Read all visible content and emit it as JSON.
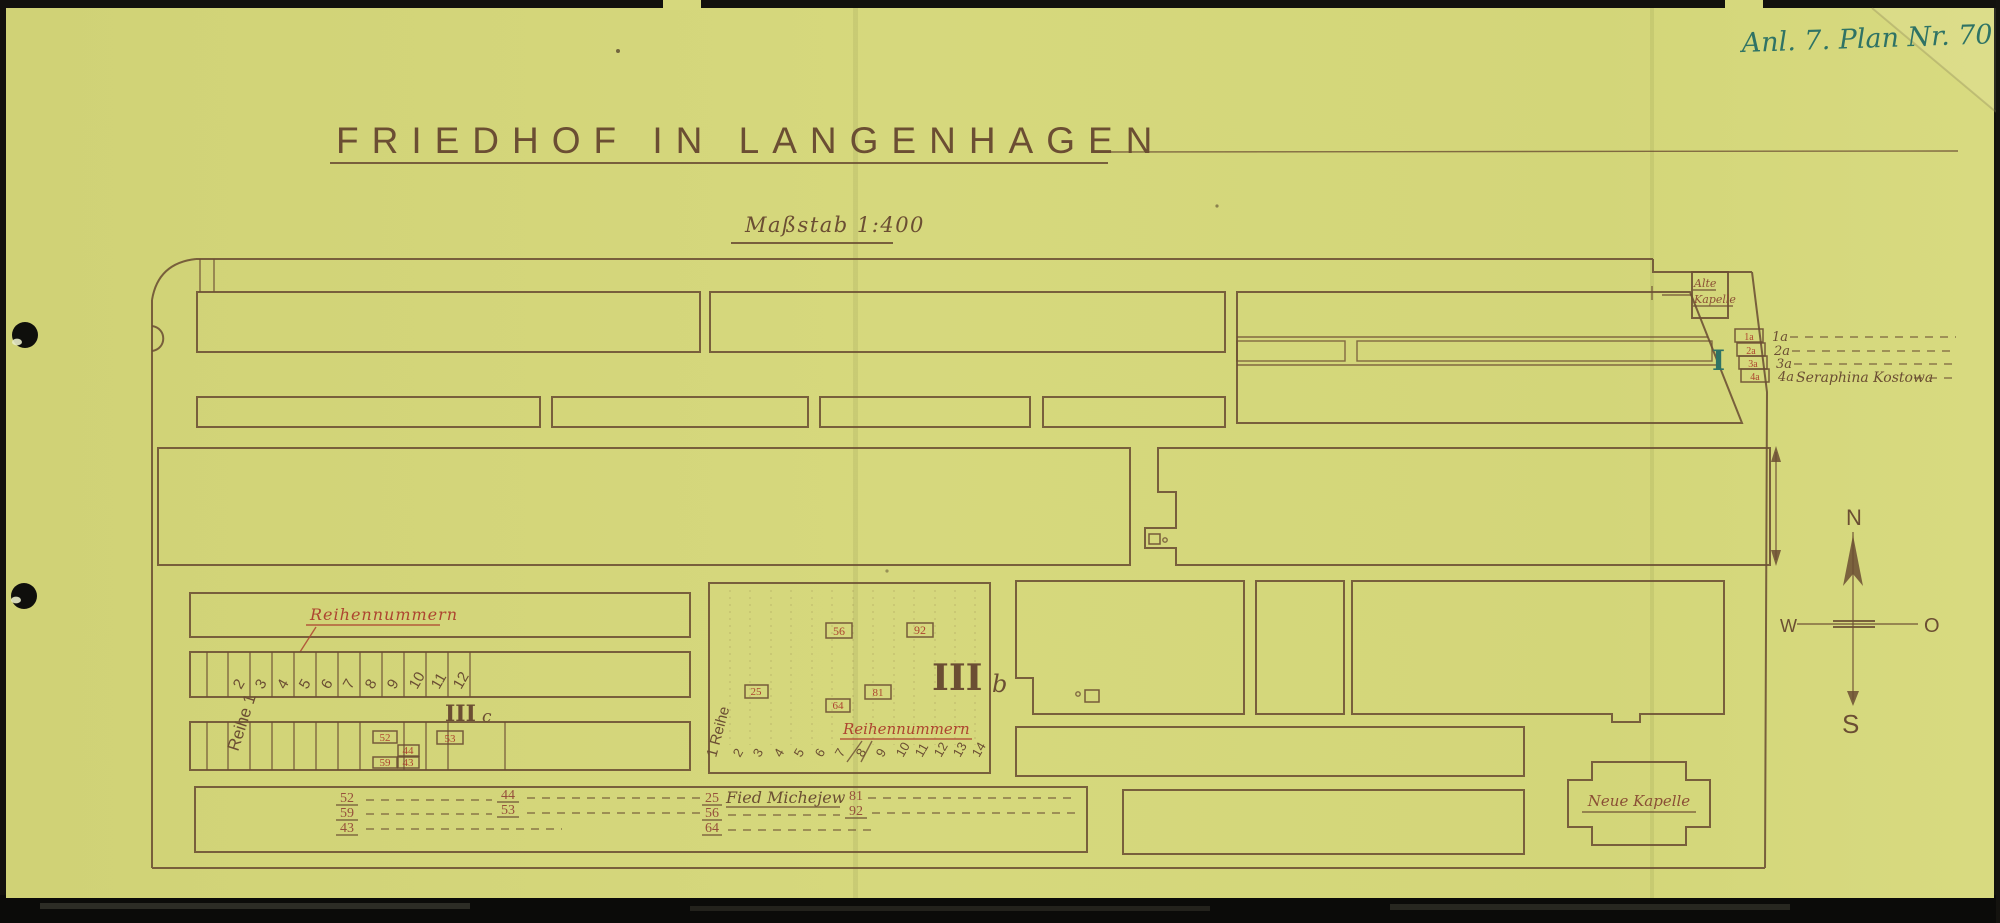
{
  "archive_note": "Anl. 7. Plan Nr. 70",
  "title": "FRIEDHOF IN LANGENHAGEN",
  "scale_label": "Maßstab 1:400",
  "compass": {
    "north": "N",
    "west": "W",
    "east": "O",
    "south": "S"
  },
  "alte_kapelle": {
    "line1": "Alte",
    "line2": "Kapelle"
  },
  "neue_kapelle": {
    "label": "Neue Kapelle"
  },
  "section_I": {
    "mark": "I",
    "grave_boxes": [
      "1a",
      "2a",
      "3a",
      "4a"
    ],
    "row_labels": [
      "1a",
      "2a",
      "3a",
      "4a"
    ],
    "name_on_4a": "Seraphina Kostowa"
  },
  "section_IIIc": {
    "roman": "III",
    "letter": "c",
    "row_label": "Reihe 1",
    "red_caption": "Reihennummern",
    "columns": [
      "2",
      "3",
      "4",
      "5",
      "6",
      "7",
      "8",
      "9",
      "10",
      "11",
      "12"
    ],
    "grave_boxes": [
      "52",
      "44",
      "59",
      "43",
      "53"
    ]
  },
  "section_IIIb": {
    "roman": "III",
    "letter": "b",
    "row_label": "1 Reihe",
    "red_caption": "Reihennummern",
    "columns": [
      "2",
      "3",
      "4",
      "5",
      "6",
      "7",
      "8",
      "9",
      "10",
      "11",
      "12",
      "13",
      "14"
    ],
    "grave_boxes": [
      "56",
      "92",
      "25",
      "64",
      "81"
    ]
  },
  "ledger_left": {
    "rows": [
      {
        "a": "52",
        "b": "44"
      },
      {
        "a": "59",
        "b": "53"
      },
      {
        "a": "43",
        "b": ""
      }
    ]
  },
  "ledger_right": {
    "rows": [
      {
        "a": "25",
        "name": "Fied Michejew",
        "b": "81"
      },
      {
        "a": "56",
        "name": "",
        "b": "92"
      },
      {
        "a": "64",
        "name": "",
        "b": ""
      }
    ]
  },
  "colors": {
    "paper": "#d5d77b",
    "pencil": "#6b4e33",
    "red_ink": "#ad4530",
    "teal_ink": "#2f7365",
    "background": "#12110d"
  }
}
